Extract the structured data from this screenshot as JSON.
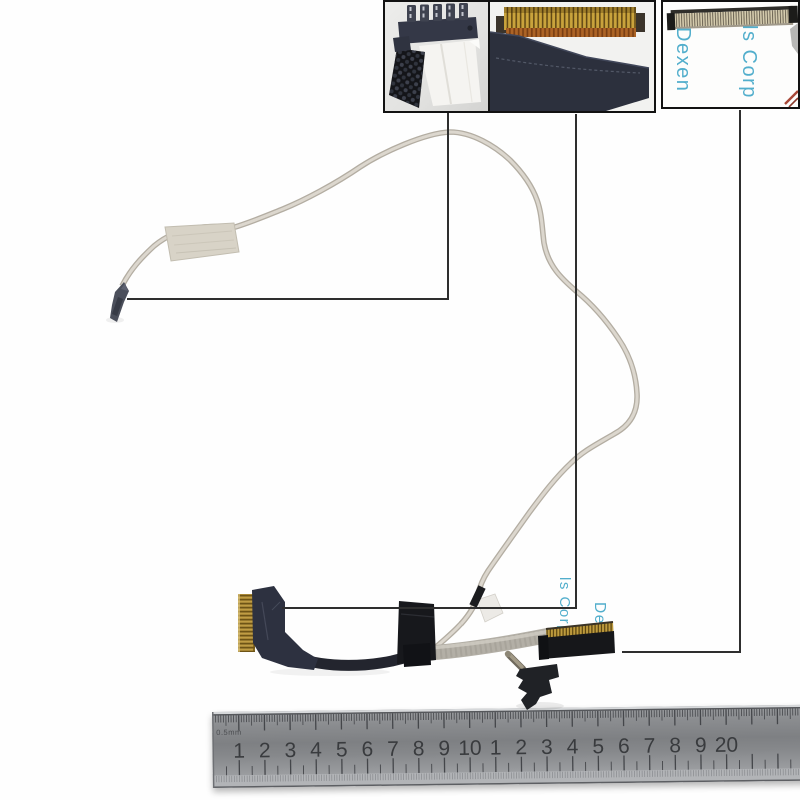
{
  "photo": {
    "watermark_line1": "ls Corp",
    "watermark_line2": "Dexen"
  },
  "insets": {
    "right_watermark_line1": "Dexen",
    "right_watermark_line2": "ls Corp"
  },
  "ruler": {
    "micro_label": "0.5mm",
    "cm_labels": [
      "1",
      "2",
      "3",
      "4",
      "5",
      "6",
      "7",
      "8",
      "9",
      "10",
      "1",
      "2",
      "3",
      "4",
      "5",
      "6",
      "7",
      "8",
      "9",
      "20"
    ]
  },
  "colors": {
    "callout_line": "#2e2e2e",
    "watermark_blue": "#3ba4c6",
    "cable_gray": "#d8d3ca",
    "fabric_navy": "#2d3140",
    "connector_gold": "#b8923a",
    "black_tape": "#17181c",
    "ruler_body": "#8a8c8f"
  }
}
